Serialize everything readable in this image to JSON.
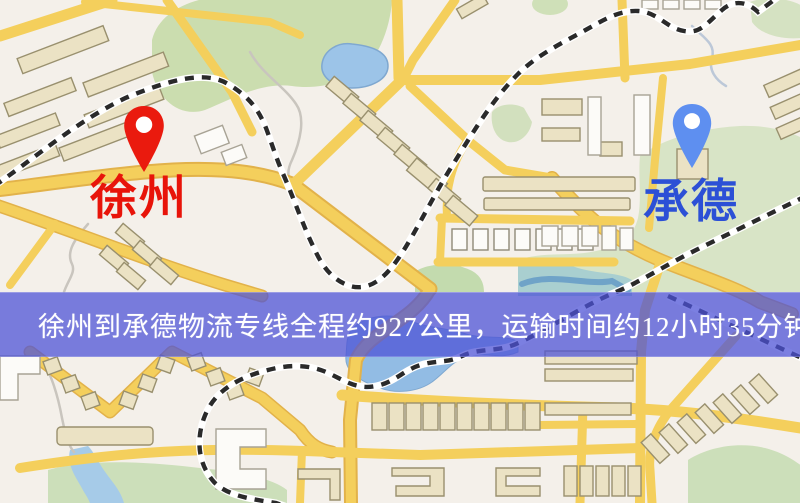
{
  "markers": [
    {
      "name": "徐州",
      "label_color": "#e8140a",
      "pin_color": "#ea1a0e"
    },
    {
      "name": "承德",
      "label_color": "#2c50d6",
      "pin_color": "#5e8ff0"
    }
  ],
  "banner": {
    "text": "徐州到承德物流专线全程约927公里，运输时间约12小时35分钟.",
    "bg_color": "#4d52d7",
    "text_color": "#ffffff"
  },
  "map_colors": {
    "background": "#f4f0ea",
    "road_fill": "#f4cf5c",
    "road_casing": "#e2b24a",
    "park": "#cfe0b6",
    "water": "#9cc4e8",
    "railway": "#2a2a2a",
    "building": "#ebe2c4"
  }
}
